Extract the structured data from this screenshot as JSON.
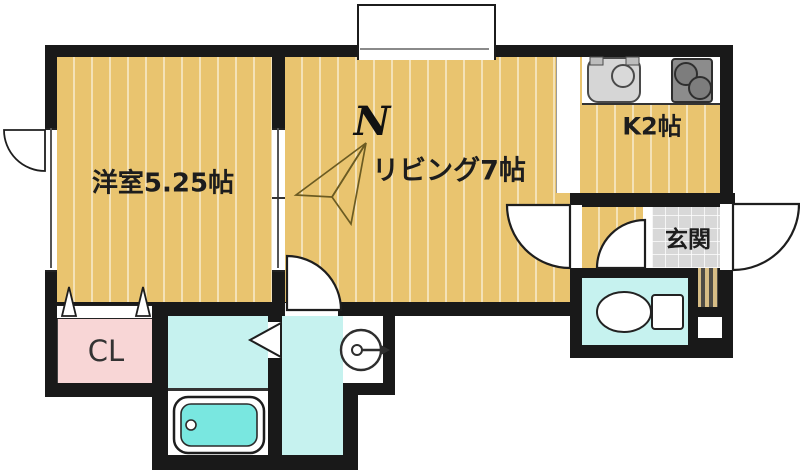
{
  "plan_title": "apartment-floor-plan",
  "compass": {
    "label": "N"
  },
  "rooms": {
    "western_room": {
      "label": "洋室5.25帖"
    },
    "living": {
      "label": "リビング7帖"
    },
    "kitchen": {
      "label": "K2帖"
    },
    "entrance": {
      "label": "玄関"
    },
    "closet": {
      "label": "CL"
    }
  },
  "fixtures": [
    "kitchen-sink",
    "gas-stove",
    "toilet",
    "bathtub",
    "washing-machine-pan",
    "bay-window",
    "entrance-door",
    "folding-closet-door",
    "folding-bath-door",
    "sliding-partition-door",
    "compass-north-needle"
  ],
  "colors": {
    "wall": "#191919",
    "flooring_tan": "#e9c46f",
    "closet_pink": "#f8d6d6",
    "wet_area_cyan": "#c6f2ef",
    "bathtub_cyan": "#79e7e0",
    "entrance_tile_gray": "#d8d8d8",
    "sink_gray": "#d6d6d6",
    "stove_gray": "#8c8c8c"
  }
}
